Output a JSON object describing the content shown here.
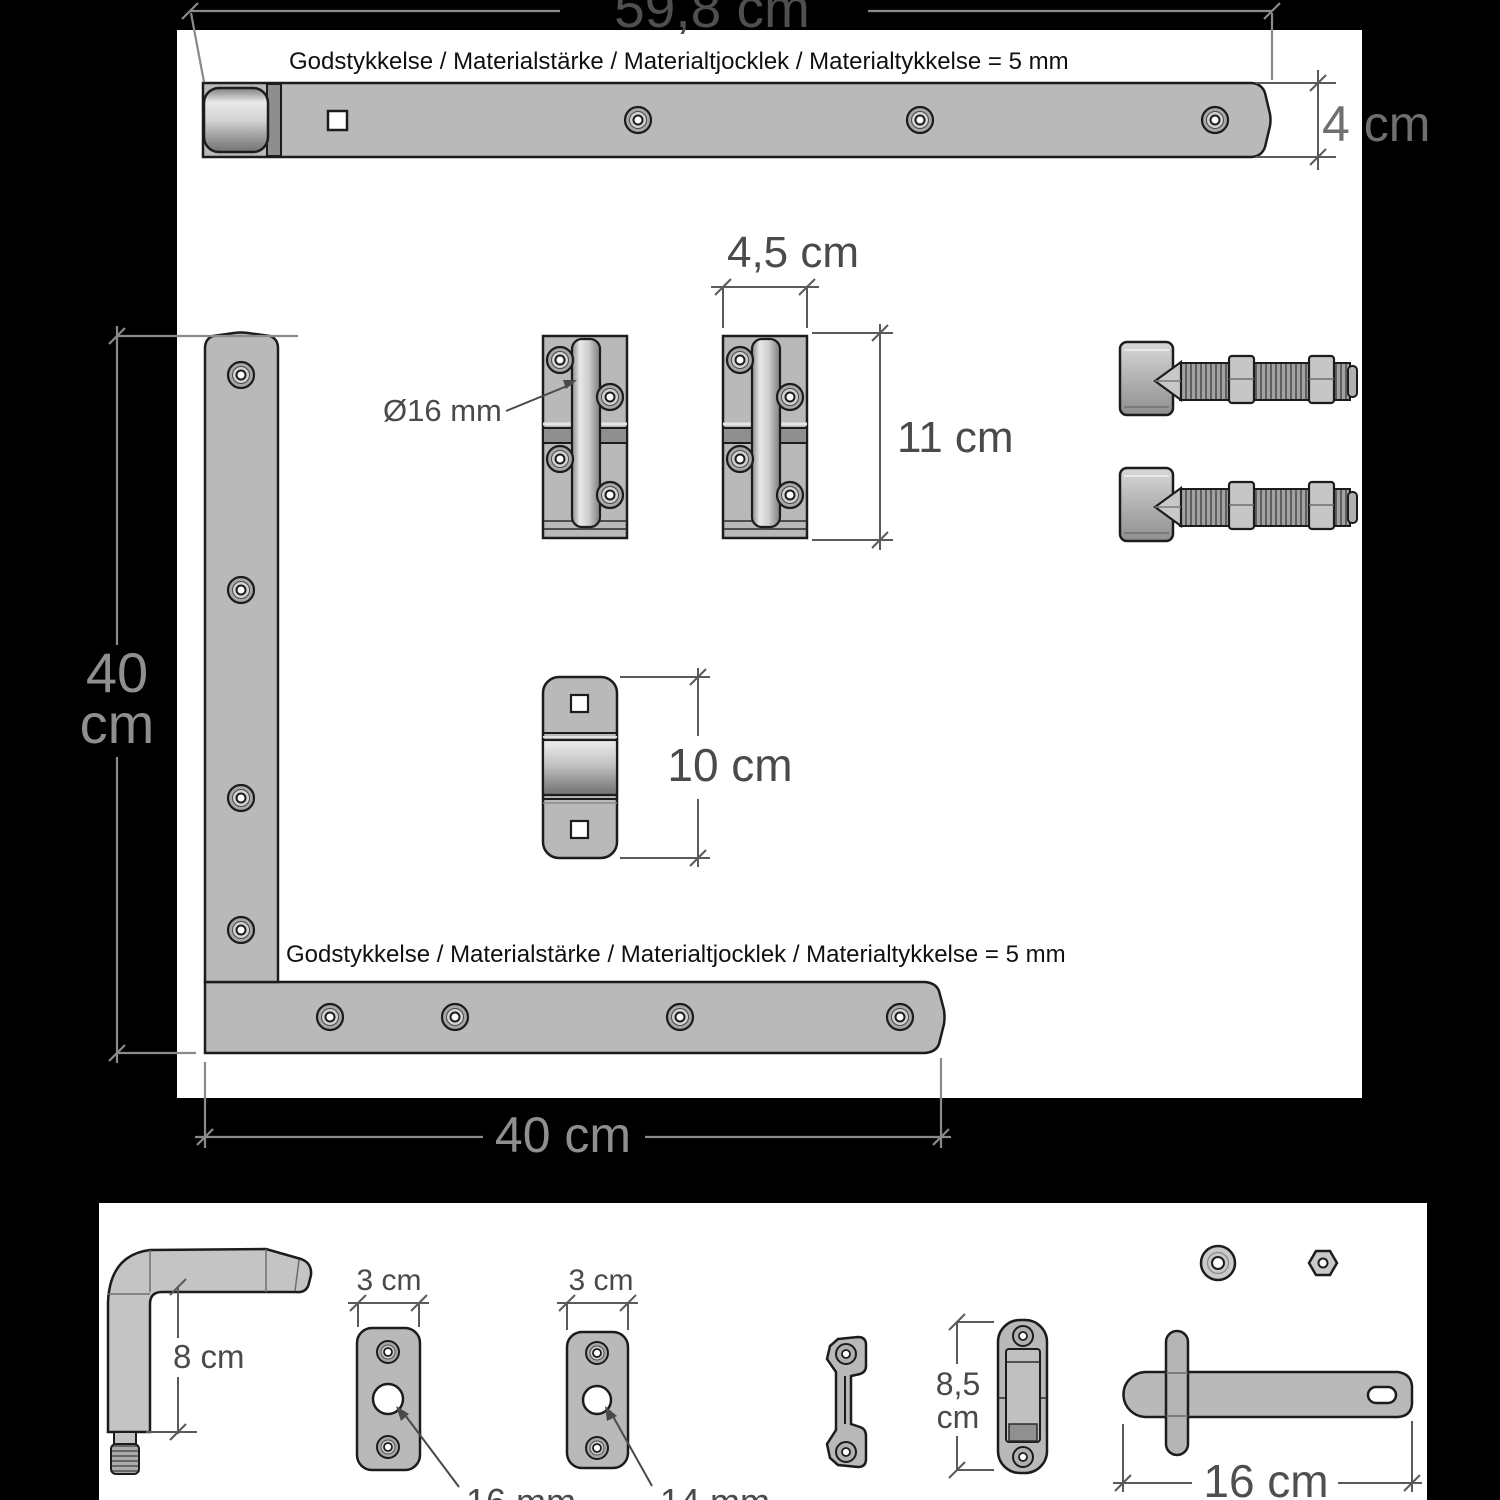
{
  "colors": {
    "background": "#000000",
    "panel": "#ffffff",
    "metal": "#b9b9b9",
    "metal_light": "#e8e8e8",
    "metal_dark": "#8f8f8f",
    "outline": "#1c1c1c",
    "dimension_on_white": "#4a4a4a",
    "dimension_on_black": "#8a8a8a"
  },
  "top_strap": {
    "length_dim": "59,8 cm",
    "height_dim": "4 cm",
    "material_note": "Godstykkelse / Materialstärke / Materialtjocklek / Materialtykkelse = 5 mm"
  },
  "socket_hinges": {
    "width_dim": "4,5 cm",
    "height_dim": "11 cm",
    "pin_diameter_label": "Ø16 mm"
  },
  "gate_bracket": {
    "height_dim": "10 cm"
  },
  "corner_hinge": {
    "material_note": "Godstykkelse / Materialstärke / Materialtjocklek / Materialtykkelse = 5 mm",
    "vertical_dim_line1": "40",
    "vertical_dim_line2": "cm",
    "horizontal_dim": "40 cm"
  },
  "bottom_panel": {
    "l_pin": {
      "height_dim": "8 cm"
    },
    "plate_16": {
      "width_dim": "3 cm",
      "hole_label": "16 mm"
    },
    "plate_14": {
      "width_dim": "3 cm",
      "hole_label": "14 mm"
    },
    "latch_keeper": {
      "height_dim_line1": "8,5",
      "height_dim_line2": "cm"
    },
    "latch_bar": {
      "length_dim": "16 cm"
    }
  }
}
